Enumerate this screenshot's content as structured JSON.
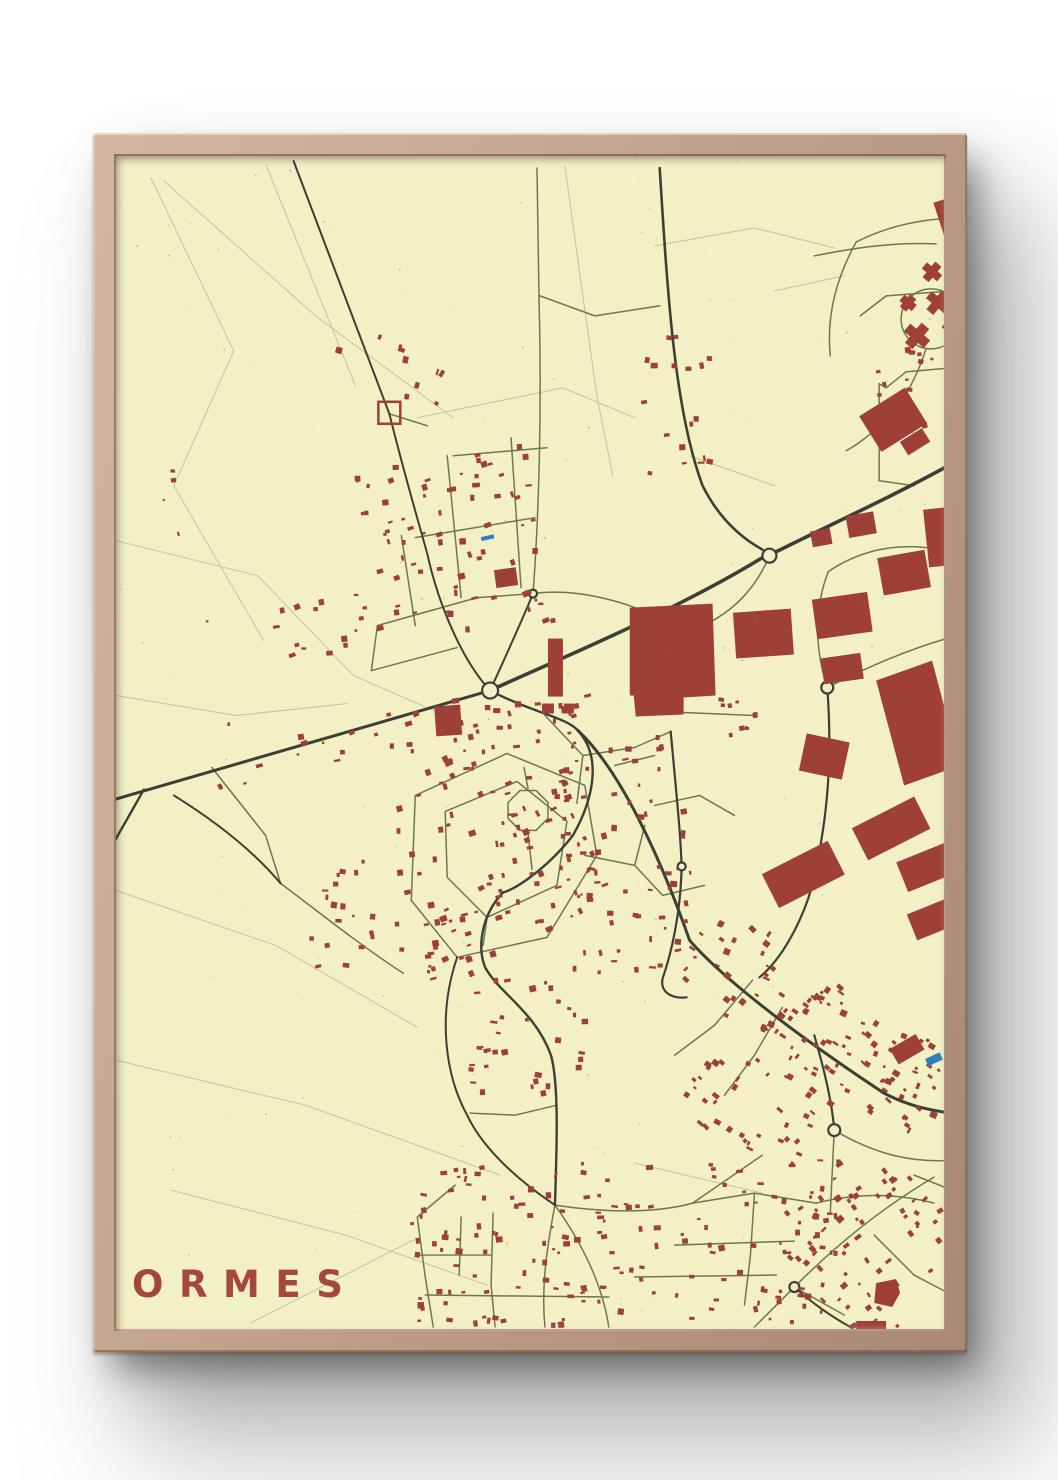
{
  "poster": {
    "title": "ORMES",
    "title_color": "#a5463f",
    "background": "#f4f0c5"
  },
  "frame": {
    "wood_color": "#c6a791",
    "wood_color_dark": "#a98875",
    "shadow_color": "#6b6b6b"
  },
  "map": {
    "width": 830,
    "height": 1174,
    "colors": {
      "background": "#f4f0c5",
      "building": "#9e3f39",
      "road_major": "#3a4036",
      "road_minor": "#6e7554",
      "field_line": "#c4c09a",
      "water": "#2f7fc0",
      "speckle": "#8d8657"
    },
    "roads_field": [
      "M 35 22 L 118 195 L 58 330 L 148 485",
      "M 48 25 L 200 160 L 338 262",
      "M 150 8 L 240 230",
      "M 450 10 L 468 140 L 482 240 L 498 320",
      "M 0 385 L 142 420 L 238 520",
      "M 0 540 L 120 560 L 232 548",
      "M 0 735 L 160 790 L 302 872",
      "M 0 905 L 190 950 L 385 1020",
      "M 55 1035 L 230 1080 L 372 1130",
      "M 135 1168 L 298 1085",
      "M 302 262 L 448 232 L 520 262",
      "M 540 90 L 640 72 L 720 92",
      "M 520 1008 L 648 1038",
      "M 238 520 L 330 560",
      "M 575 300 L 660 330",
      "M 660 135 L 730 120"
    ],
    "roads_minor": [
      "M 262 470 L 362 442",
      "M 300 382 L 420 362",
      "M 338 300 L 432 292",
      "M 256 515 L 342 492",
      "M 332 300 L 346 442",
      "M 396 282 L 406 432",
      "M 262 470 L 256 515",
      "M 362 442 L 418 438",
      "M 286 380 L 300 470",
      "M 418 438 C 424 360 427 250 424 140 L 422 12",
      "M 418 438 C 460 432 520 446 556 470",
      "M 274 258 L 312 270",
      "M 545 150 L 480 160 L 425 140",
      "M 300 640 L 392 598 L 470 630 L 482 700 L 432 782 L 342 802 L 296 745 Z",
      "M 330 656 L 402 626 L 452 666 L 442 730 L 372 762 L 332 722 Z",
      "M 433 663 L 421 675 L 405 675 L 393 663 L 393 647 L 405 635 L 421 635 L 433 647 Z",
      "M 413 677 L 417 714",
      "M 413 633 L 409 612",
      "M 372 762 L 368 790",
      "M 430 560 L 468 600 L 520 592",
      "M 468 600 L 462 648",
      "M 500 610 L 540 600",
      "M 520 592 L 556 576",
      "M 540 650 L 585 640 L 620 660",
      "M 470 700 L 520 710 L 548 740",
      "M 520 710 L 530 670",
      "M 548 740 L 590 730",
      "M 442 950 L 400 960 L 355 958",
      "M 165 728 C 205 758 245 790 288 818",
      "M 96 612 L 150 680 L 165 728",
      "M 440 1050 C 492 1058 542 1058 578 1048",
      "M 440 1050 C 432 1092 426 1132 430 1172",
      "M 440 1050 C 470 1092 488 1132 494 1172",
      "M 378 1058 L 376 1130 L 380 1172",
      "M 340 1030 L 302 1062 L 310 1122 L 318 1172",
      "M 302 1100 L 376 1100",
      "M 310 1140 L 494 1142",
      "M 346 1062 L 344 1120",
      "M 578 1048 L 640 1038 L 702 1048",
      "M 640 1038 L 636 1100 L 630 1150",
      "M 560 1090 L 680 1086",
      "M 520 1122 L 662 1120",
      "M 702 1048 C 742 1038 782 1038 820 1048",
      "M 720 975 L 716 1058",
      "M 648 1000 L 578 1048",
      "M 720 975 C 762 1000 800 1008 838 1005",
      "M 680 1132 C 722 1090 766 1054 820 1022",
      "M 680 1132 L 640 1172",
      "M 680 1132 L 730 1160",
      "M 760 1080 L 800 1120 L 838 1140",
      "M 800 1020 L 838 1035",
      "M 638 825 L 600 870 L 560 900",
      "M 668 852 L 640 900 L 610 940",
      "M 713 532 C 700 492 700 452 714 416",
      "M 714 416 C 745 395 780 388 812 392",
      "M 713 532 C 760 508 800 492 836 482",
      "M 560 480 C 600 470 636 446 655 400",
      "M 560 480 C 545 500 540 530 545 556",
      "M 545 556 L 640 560",
      "M 765 228 L 765 325",
      "M 765 325 L 800 330",
      "M 787 163 a 30 30 0 1 0 60 0 a 30 30 0 1 0 -60 0",
      "M 812 193 C 806 212 798 228 790 242",
      "M 790 242 C 770 268 750 285 732 295",
      "M 838 62 C 800 64 770 72 742 86",
      "M 742 86 C 722 122 712 160 716 200",
      "M 700 100 C 740 92 780 86 822 88",
      "M 838 135 L 772 140 L 746 160",
      "M 838 212 L 792 216 L 772 232",
      "M 772 232 L 765 228"
    ],
    "roads_major": [
      {
        "d": "M -5 645 C 130 606 258 568 375 535",
        "w": 3
      },
      {
        "d": "M 375 535 C 438 506 556 458 648 402",
        "w": 3.6
      },
      {
        "d": "M 662 396 C 718 368 780 340 838 308",
        "w": 3.6
      },
      {
        "d": "M 545 12 C 553 140 560 255 588 330 C 606 366 630 384 648 394",
        "w": 2.6
      },
      {
        "d": "M 178 5 L 274 258 C 290 322 302 362 312 398 C 324 452 348 506 375 535",
        "w": 2
      },
      {
        "d": "M 418 438 C 404 472 389 504 375 535",
        "w": 2
      },
      {
        "d": "M 28 634 L -5 692",
        "w": 2.4
      },
      {
        "d": "M 58 640 C 100 666 138 696 165 728",
        "w": 2
      },
      {
        "d": "M 375 535 C 420 558 452 562 463 575 C 488 602 478 645 458 680 C 430 716 396 736 388 737 C 366 760 362 792 370 812 C 384 838 420 856 436 900 C 444 928 442 990 440 1050",
        "w": 2.4
      },
      {
        "d": "M 463 575 C 505 614 545 700 575 785 C 612 828 700 892 770 938 C 792 950 815 955 838 958",
        "w": 3
      },
      {
        "d": "M 713 532 C 718 600 714 660 700 720 C 694 752 672 800 645 822",
        "w": 2.2
      },
      {
        "d": "M 556 576 C 562 640 566 680 567 711 C 566 760 556 800 548 823 C 545 836 556 844 572 842",
        "w": 2.2
      },
      {
        "d": "M 700 880 C 712 922 718 950 720 975",
        "w": 2.2
      },
      {
        "d": "M 342 802 C 322 860 330 920 352 960 C 366 990 398 1022 440 1050",
        "w": 2
      },
      {
        "d": "M 680 1132 C 700 1150 718 1162 736 1172",
        "w": 2
      }
    ],
    "roundabouts": [
      {
        "cx": 375,
        "cy": 535,
        "r": 8
      },
      {
        "cx": 655,
        "cy": 400,
        "r": 7
      },
      {
        "cx": 713,
        "cy": 532,
        "r": 6
      },
      {
        "cx": 720,
        "cy": 975,
        "r": 6
      },
      {
        "cx": 680,
        "cy": 1132,
        "r": 5
      },
      {
        "cx": 567,
        "cy": 711,
        "r": 4
      },
      {
        "cx": 418,
        "cy": 438,
        "r": 4
      }
    ],
    "buildings_large": [
      {
        "pts": "515,452 598,448 601,540 569,542 569,559 521,561 519,540 515,540"
      },
      {
        "x": 620,
        "y": 455,
        "w": 58,
        "h": 46,
        "rot": -4
      },
      {
        "x": 700,
        "y": 440,
        "w": 56,
        "h": 40,
        "rot": -8
      },
      {
        "x": 708,
        "y": 500,
        "w": 40,
        "h": 26,
        "rot": -8
      },
      {
        "x": 766,
        "y": 398,
        "w": 48,
        "h": 38,
        "rot": -10
      },
      {
        "x": 812,
        "y": 352,
        "w": 36,
        "h": 58,
        "rot": -6
      },
      {
        "x": 733,
        "y": 358,
        "w": 28,
        "h": 22,
        "rot": -10
      },
      {
        "x": 697,
        "y": 374,
        "w": 20,
        "h": 16,
        "rot": -10
      },
      {
        "pts": "762,525 818,505 846,610 790,630"
      },
      {
        "x": 688,
        "y": 582,
        "w": 44,
        "h": 38,
        "rot": 12
      },
      {
        "x": 742,
        "y": 655,
        "w": 70,
        "h": 36,
        "rot": -27
      },
      {
        "x": 652,
        "y": 700,
        "w": 74,
        "h": 38,
        "rot": -27
      },
      {
        "x": 786,
        "y": 695,
        "w": 58,
        "h": 32,
        "rot": -22
      },
      {
        "x": 796,
        "y": 748,
        "w": 54,
        "h": 28,
        "rot": -22
      },
      {
        "x": 433,
        "y": 483,
        "w": 15,
        "h": 58,
        "rot": 0
      },
      {
        "x": 427,
        "y": 548,
        "w": 12,
        "h": 10,
        "rot": 0
      },
      {
        "x": 449,
        "y": 548,
        "w": 10,
        "h": 10,
        "rot": 0
      },
      {
        "x": 380,
        "y": 413,
        "w": 22,
        "h": 18,
        "rot": -8
      },
      {
        "x": 320,
        "y": 550,
        "w": 26,
        "h": 30,
        "rot": -4
      },
      {
        "x": 752,
        "y": 243,
        "w": 54,
        "h": 42,
        "rot": -32
      },
      {
        "x": 788,
        "y": 278,
        "w": 26,
        "h": 16,
        "rot": -32
      },
      {
        "x": 790,
        "y": 175,
        "w": 26,
        "h": 10,
        "rot": 40
      },
      {
        "x": 798,
        "y": 167,
        "w": 10,
        "h": 26,
        "rot": 40
      },
      {
        "x": 812,
        "y": 142,
        "w": 24,
        "h": 9,
        "rot": 40
      },
      {
        "x": 819,
        "y": 135,
        "w": 9,
        "h": 24,
        "rot": 40
      },
      {
        "x": 786,
        "y": 143,
        "w": 16,
        "h": 8,
        "rot": 40
      },
      {
        "x": 790,
        "y": 139,
        "w": 8,
        "h": 16,
        "rot": 40
      },
      {
        "x": 808,
        "y": 112,
        "w": 20,
        "h": 8,
        "rot": 40
      },
      {
        "x": 814,
        "y": 106,
        "w": 8,
        "h": 20,
        "rot": 40
      },
      {
        "x": 828,
        "y": 170,
        "w": 18,
        "h": 8,
        "rot": 40
      },
      {
        "x": 824,
        "y": 42,
        "w": 26,
        "h": 34,
        "rot": -18
      },
      {
        "x": 778,
        "y": 885,
        "w": 30,
        "h": 18,
        "rot": -30
      },
      {
        "pts": "762,1128 782,1124 786,1138 778,1152 760,1148"
      },
      {
        "x": 742,
        "y": 1166,
        "w": 30,
        "h": 14,
        "rot": 0
      }
    ],
    "buildings_outline": [
      {
        "x": 263,
        "y": 246,
        "w": 22,
        "h": 22
      }
    ],
    "water": [
      {
        "x": 812,
        "y": 900,
        "w": 16,
        "h": 8,
        "rot": -25
      },
      {
        "x": 366,
        "y": 380,
        "w": 13,
        "h": 4,
        "rot": -12
      }
    ],
    "house_clusters": [
      {
        "cx": 345,
        "cy": 390,
        "w": 190,
        "h": 180,
        "n": 75,
        "s": 4,
        "rot": -10
      },
      {
        "cx": 205,
        "cy": 475,
        "w": 110,
        "h": 60,
        "n": 14,
        "s": 4,
        "rot": -10
      },
      {
        "cx": 210,
        "cy": 590,
        "w": 280,
        "h": 50,
        "n": 20,
        "s": 4,
        "rot": -12
      },
      {
        "cx": 405,
        "cy": 575,
        "w": 150,
        "h": 60,
        "n": 30,
        "s": 4,
        "rot": -10
      },
      {
        "cx": 385,
        "cy": 700,
        "w": 200,
        "h": 220,
        "n": 110,
        "s": 4,
        "rot": -15
      },
      {
        "cx": 510,
        "cy": 700,
        "w": 130,
        "h": 230,
        "n": 65,
        "s": 4,
        "rot": -5
      },
      {
        "cx": 706,
        "cy": 868,
        "w": 300,
        "h": 95,
        "n": 120,
        "s": 4,
        "rot": 33
      },
      {
        "cx": 510,
        "cy": 1090,
        "w": 430,
        "h": 170,
        "n": 170,
        "s": 4,
        "rot": 0
      },
      {
        "cx": 758,
        "cy": 1090,
        "w": 150,
        "h": 170,
        "n": 80,
        "s": 4,
        "rot": -40
      },
      {
        "cx": 800,
        "cy": 230,
        "w": 80,
        "h": 110,
        "n": 22,
        "s": 4,
        "rot": 0
      },
      {
        "cx": 560,
        "cy": 250,
        "w": 80,
        "h": 140,
        "n": 18,
        "s": 4,
        "rot": 0
      },
      {
        "cx": 285,
        "cy": 215,
        "w": 50,
        "h": 130,
        "n": 10,
        "s": 4,
        "rot": -70
      },
      {
        "cx": 240,
        "cy": 760,
        "w": 95,
        "h": 110,
        "n": 22,
        "s": 4,
        "rot": 0
      },
      {
        "cx": 415,
        "cy": 880,
        "w": 130,
        "h": 120,
        "n": 34,
        "s": 4,
        "rot": 0
      },
      {
        "cx": 640,
        "cy": 950,
        "w": 130,
        "h": 90,
        "n": 40,
        "s": 4,
        "rot": 33
      },
      {
        "cx": 170,
        "cy": 520,
        "w": 260,
        "h": 420,
        "n": 8,
        "s": 3,
        "rot": 0
      },
      {
        "cx": 615,
        "cy": 560,
        "w": 60,
        "h": 50,
        "n": 10,
        "s": 3.5,
        "rot": 0
      }
    ],
    "speckles": {
      "n": 160,
      "seed": 11
    }
  }
}
